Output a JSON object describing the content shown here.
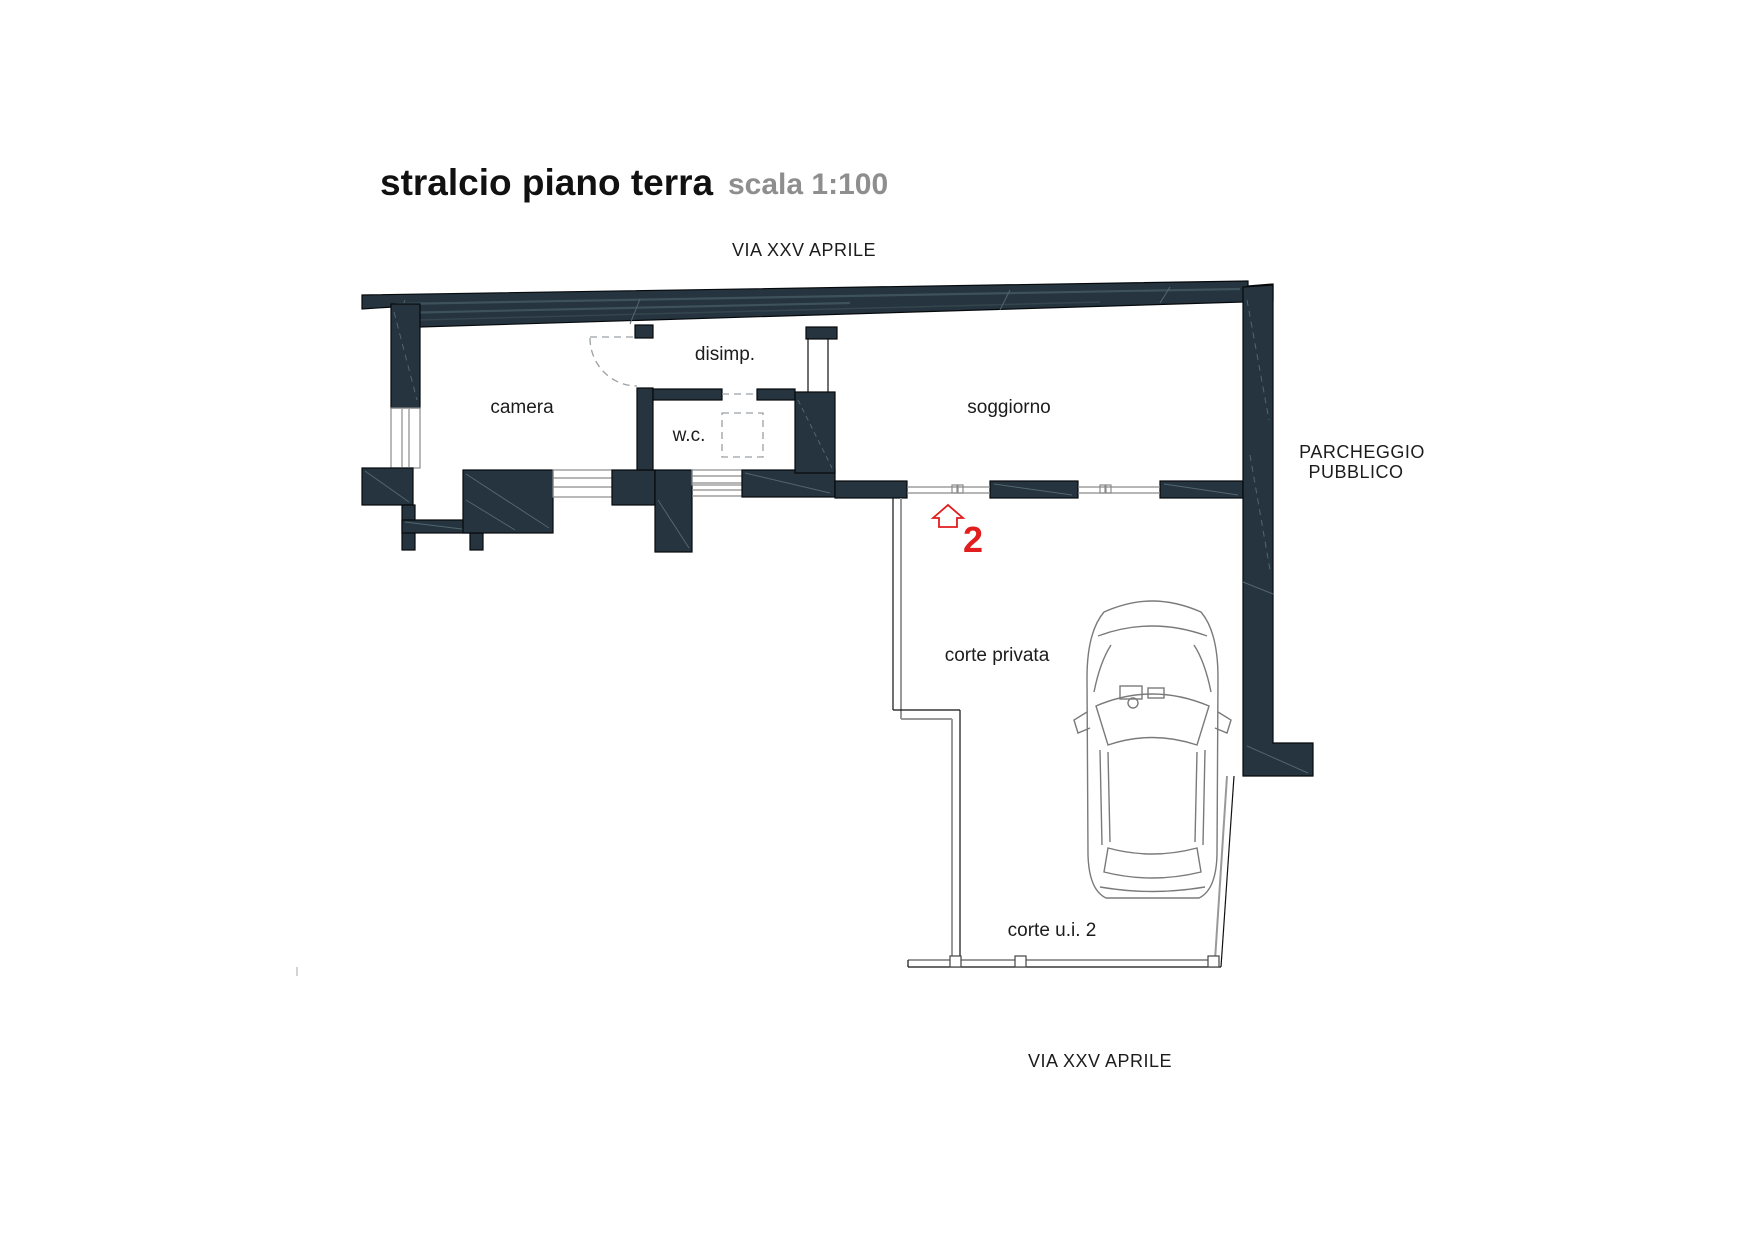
{
  "header": {
    "title": "stralcio piano terra",
    "scale_note": "scala 1:100"
  },
  "streets": {
    "top": "VIA XXV APRILE",
    "bottom": "VIA XXV APRILE"
  },
  "parking": {
    "line1": "PARCHEGGIO",
    "line2": "PUBBLICO"
  },
  "rooms": {
    "bedroom": "camera",
    "hallway": "disimp.",
    "wc": "w.c.",
    "living_room": "soggiorno",
    "private_court": "corte privata",
    "unit_court": "corte u.i. 2"
  },
  "unit_marker": {
    "number": "2",
    "icon": "house-icon",
    "color": "#e11d1d"
  },
  "palette": {
    "wall": "#25343e",
    "wall_hatch": "#52666f",
    "thin_line": "#8a8a8a",
    "dashed_line": "#9aa0a3",
    "text": "#1c1c1c",
    "muted_text": "#8e8e8e",
    "red": "#e11d1d",
    "background": "#ffffff"
  }
}
